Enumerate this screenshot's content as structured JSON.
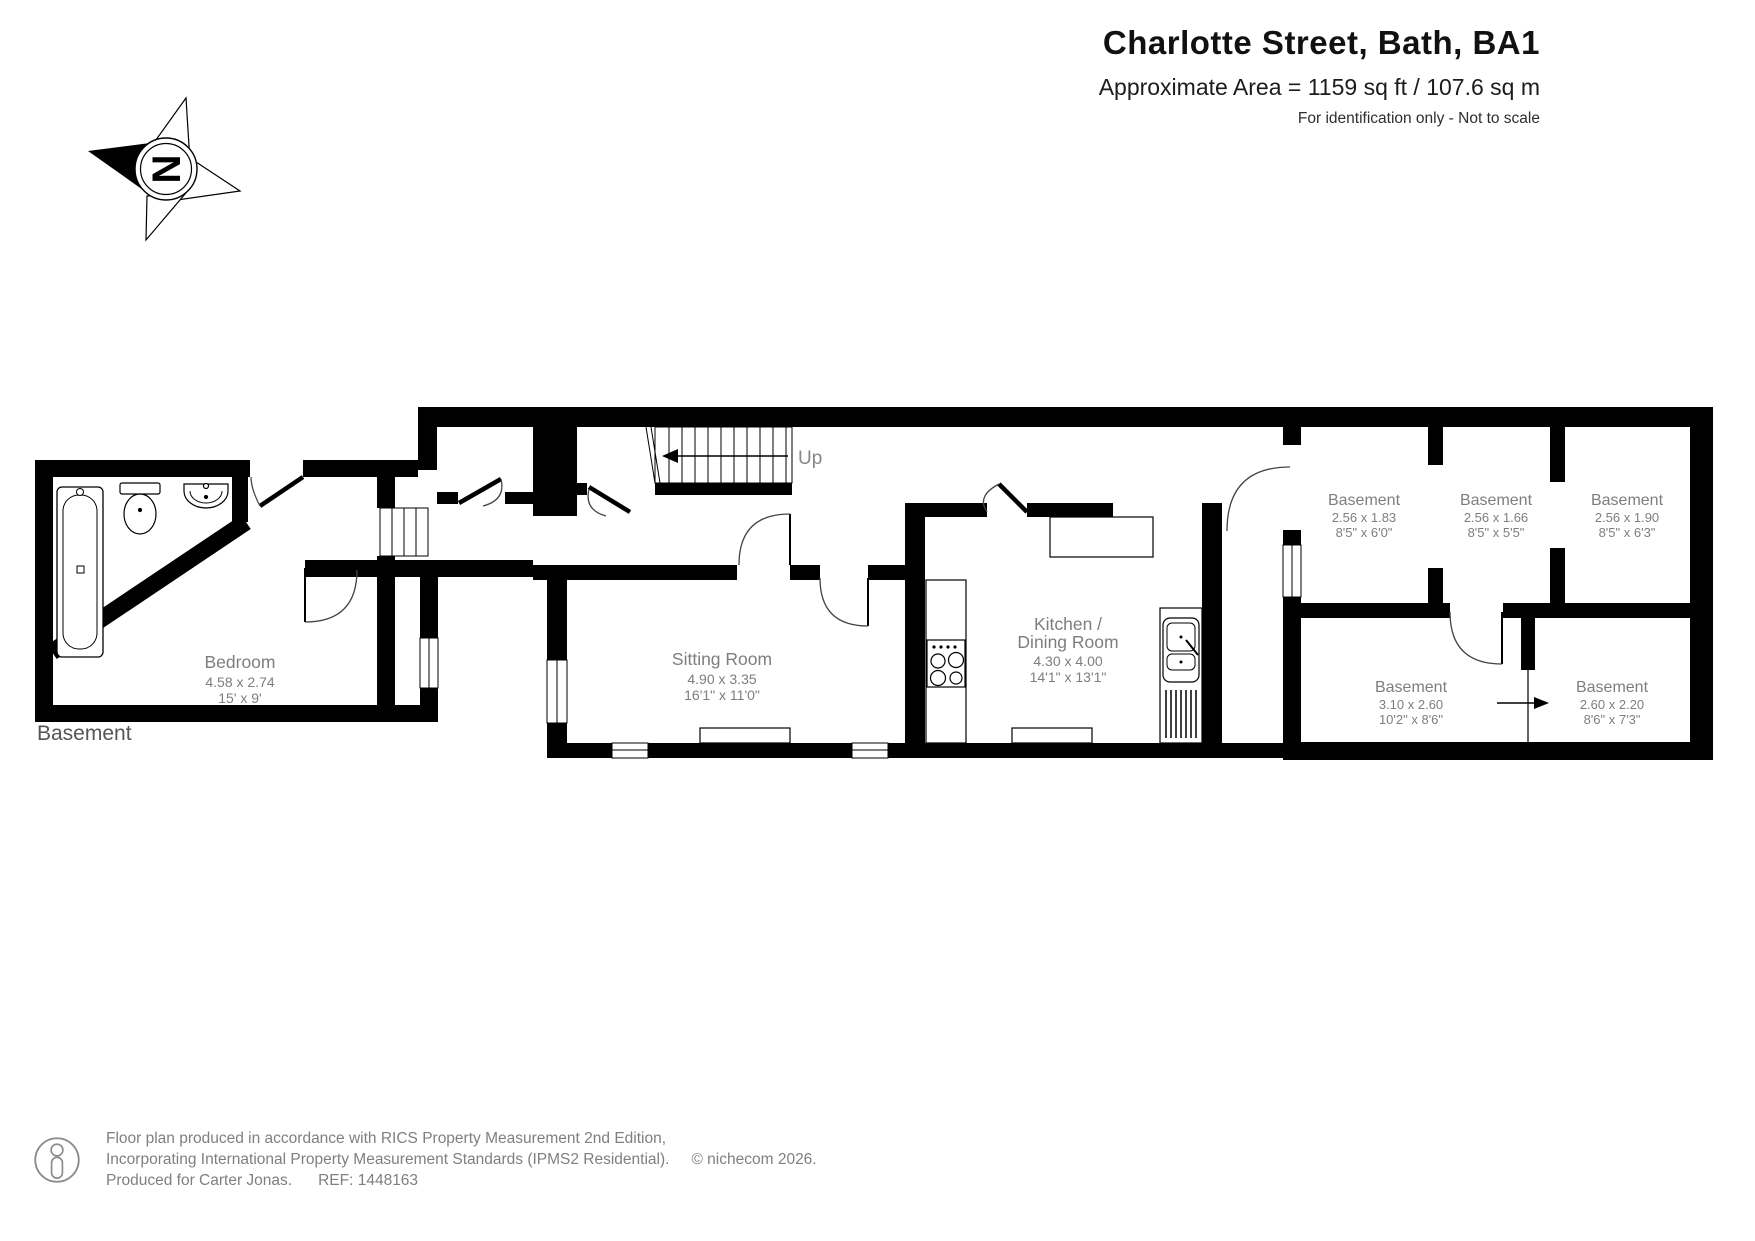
{
  "header": {
    "title": "Charlotte Street, Bath, BA1",
    "area": "Approximate Area = 1159 sq ft / 107.6 sq m",
    "note": "For identification only - Not to scale"
  },
  "compass": {
    "label": "N"
  },
  "floor_label": "Basement",
  "stairs": {
    "label": "Up"
  },
  "rooms": {
    "bedroom": {
      "name": "Bedroom",
      "metric": "4.58 x 2.74",
      "imperial": "15' x 9'"
    },
    "sitting": {
      "name": "Sitting Room",
      "metric": "4.90 x 3.35",
      "imperial": "16'1\" x 11'0\""
    },
    "kitchen": {
      "name_line1": "Kitchen /",
      "name_line2": "Dining Room",
      "metric": "4.30 x 4.00",
      "imperial": "14'1\" x 13'1\""
    },
    "basement_a": {
      "name": "Basement",
      "metric": "2.56 x 1.83",
      "imperial": "8'5\" x 6'0\""
    },
    "basement_b": {
      "name": "Basement",
      "metric": "2.56 x 1.66",
      "imperial": "8'5\" x 5'5\""
    },
    "basement_c": {
      "name": "Basement",
      "metric": "2.56 x 1.90",
      "imperial": "8'5\" x 6'3\""
    },
    "basement_d": {
      "name": "Basement",
      "metric": "3.10 x 2.60",
      "imperial": "10'2\" x 8'6\""
    },
    "basement_e": {
      "name": "Basement",
      "metric": "2.60 x 2.20",
      "imperial": "8'6\" x 7'3\""
    }
  },
  "footer": {
    "line1": "Floor plan produced in accordance with RICS Property Measurement 2nd Edition,",
    "line2": "Incorporating International Property Measurement Standards (IPMS2 Residential).",
    "copyright": "© nichecom 2026.",
    "line3": "Produced for Carter Jonas.",
    "ref": "REF: 1448163"
  },
  "colors": {
    "wall": "#000000",
    "label_grey": "#7e7e7e",
    "background": "#ffffff"
  }
}
